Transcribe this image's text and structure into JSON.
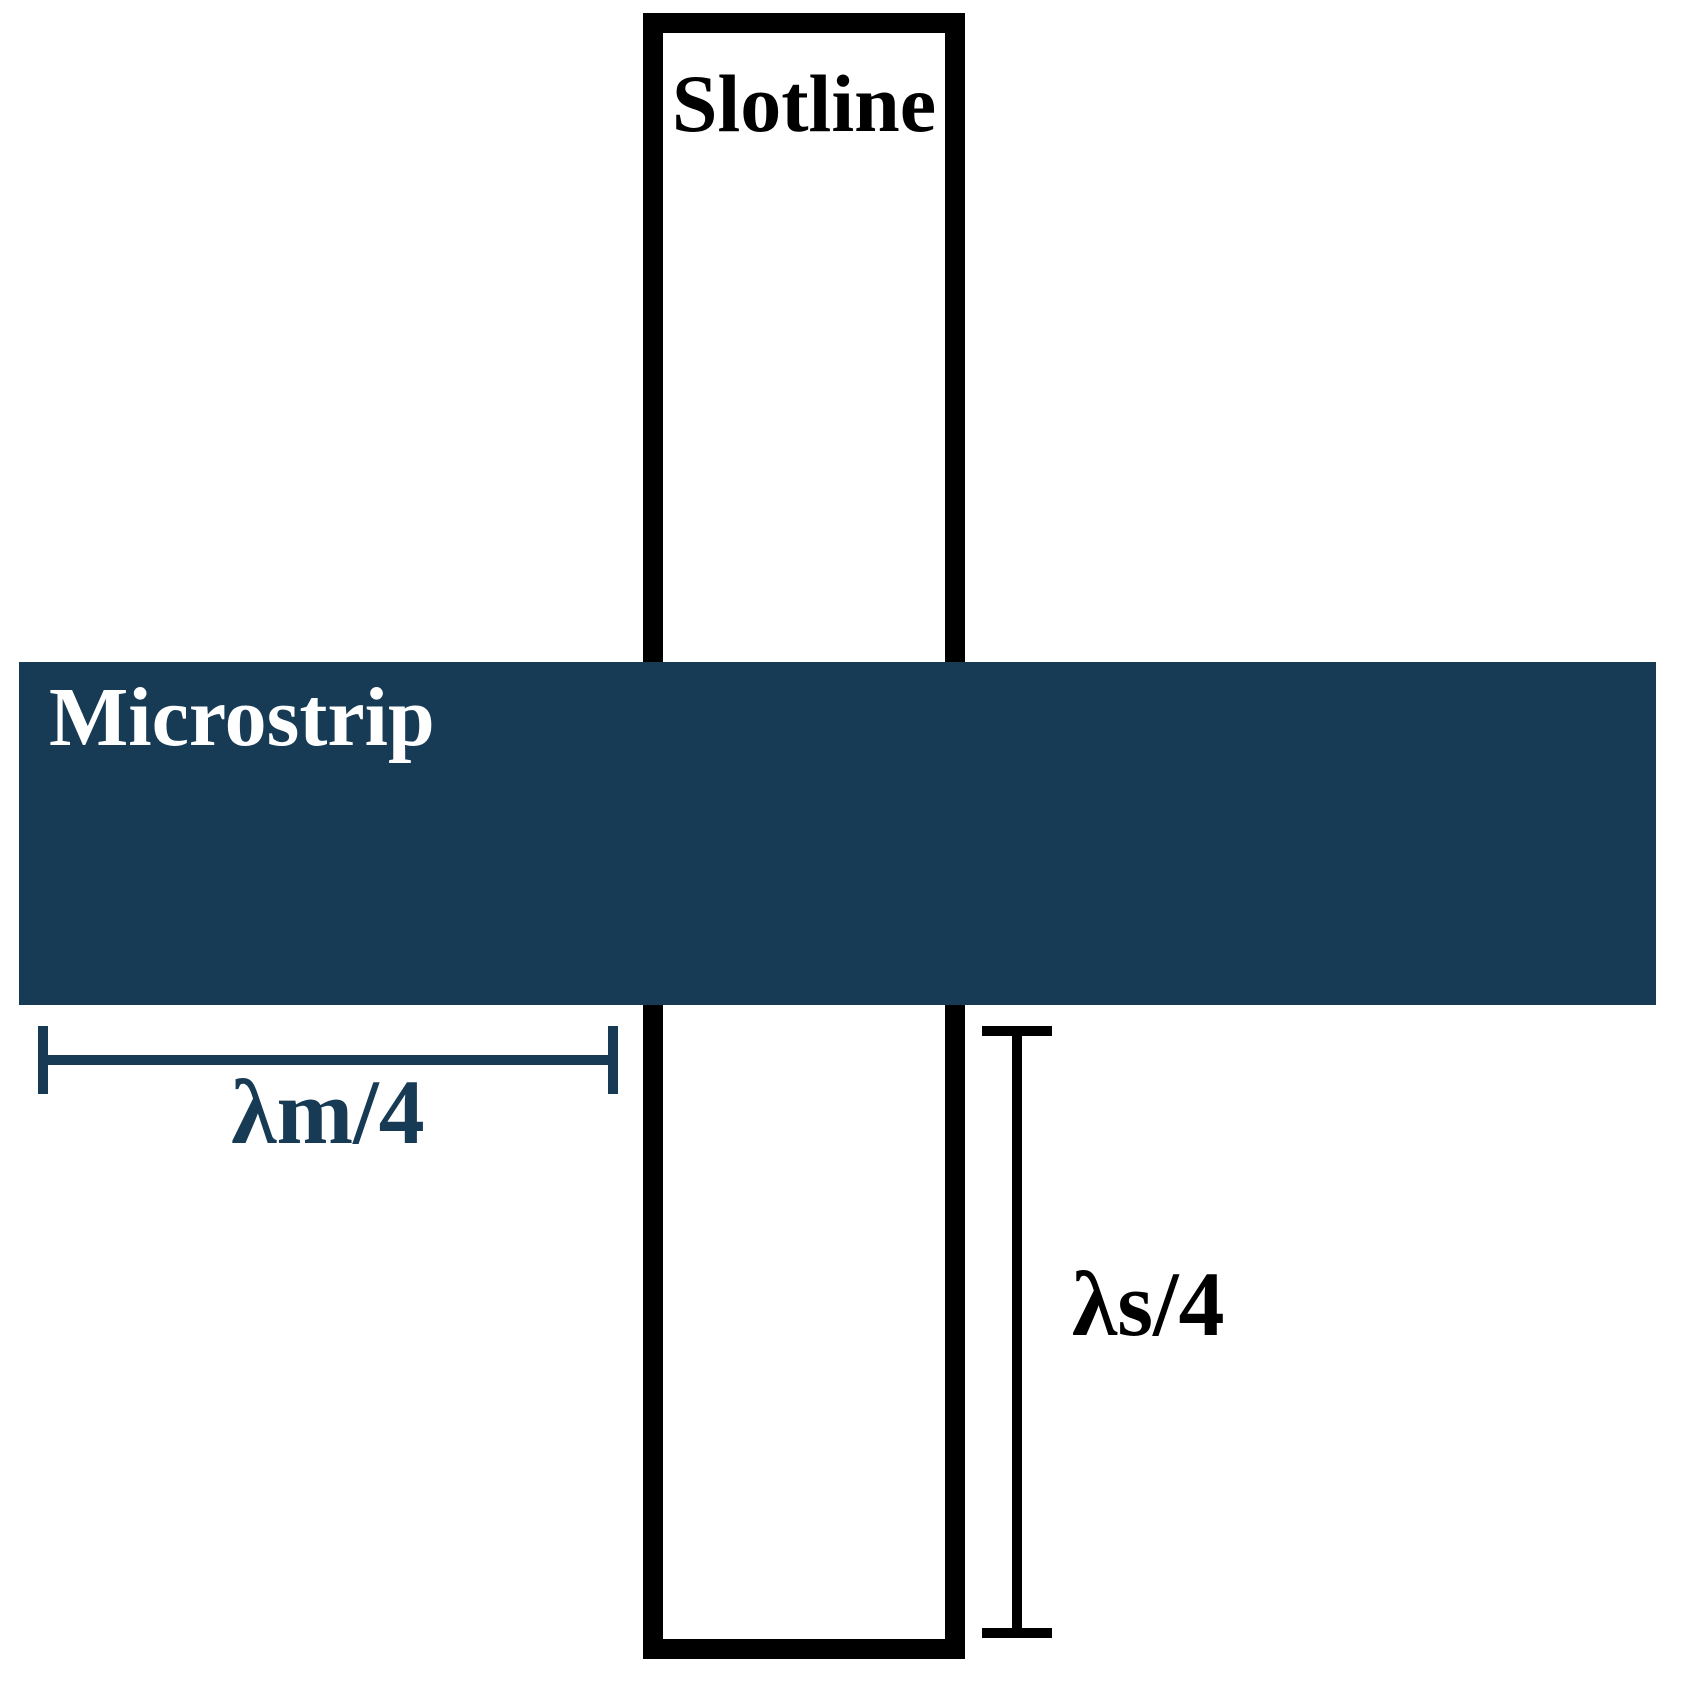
{
  "diagram": {
    "title_context": "Microstrip-to-slotline transition diagram",
    "slotline": {
      "label": "Slotline"
    },
    "microstrip": {
      "label": "Microstrip"
    },
    "dimensions": {
      "microstrip_quarter_wavelength": "λm/4",
      "slotline_quarter_wavelength": "λs/4"
    }
  },
  "colors": {
    "microstrip_fill": "#173B55",
    "slotline_outline": "#000000",
    "background": "#FFFFFF",
    "microstrip_label_text": "#FFFFFF",
    "lm_dimension_color": "#173B55",
    "ls_dimension_color": "#000000"
  }
}
